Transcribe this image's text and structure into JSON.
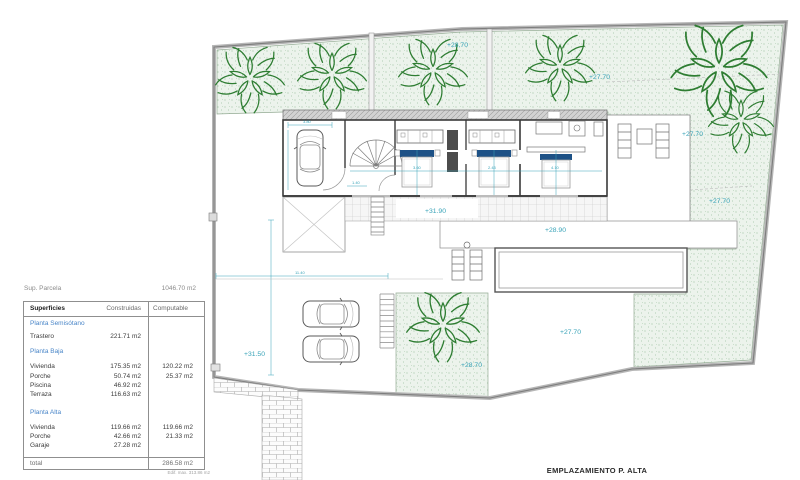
{
  "summary": {
    "label": "Sup. Parcela",
    "value": "1046.70 m2"
  },
  "table": {
    "col_name": "Superficies",
    "col_built": "Construidas",
    "col_comp": "Computable",
    "rows": [
      {
        "name": "Planta Semisótano",
        "section": true
      },
      {
        "name": "Trastero",
        "built": "221.71 m2",
        "comp": ""
      },
      {
        "name": "Planta Baja",
        "section": true
      },
      {
        "name": "Vivienda",
        "built": "175.35 m2",
        "comp": "120.22 m2"
      },
      {
        "name": "Porche",
        "built": "50.74 m2",
        "comp": "25.37 m2"
      },
      {
        "name": "Piscina",
        "built": "46.92 m2",
        "comp": ""
      },
      {
        "name": "Terraza",
        "built": "116.63 m2",
        "comp": ""
      },
      {
        "name": "Planta Alta",
        "section": true
      },
      {
        "name": "Vivienda",
        "built": "119.66 m2",
        "comp": "119.66 m2"
      },
      {
        "name": "Porche",
        "built": "42.66 m2",
        "comp": "21.33 m2"
      },
      {
        "name": "Garaje",
        "built": "27.28 m2",
        "comp": ""
      }
    ],
    "total_label": "total",
    "total_value": "286.58 m2",
    "footnote": "Edif. max. 313.86 m2"
  },
  "plan": {
    "title": "EMPLAZAMIENTO P. ALTA",
    "elevations": [
      {
        "text": "+28.70"
      },
      {
        "text": "+27.70"
      },
      {
        "text": "+27.70"
      },
      {
        "text": "+27.70"
      },
      {
        "text": "+31.90"
      },
      {
        "text": "+28.90"
      },
      {
        "text": "+27.70"
      },
      {
        "text": "+28.70"
      },
      {
        "text": "+31.50"
      }
    ],
    "dims": {
      "garage": "3.80",
      "room1": "3.60",
      "room2": "2.43",
      "room3": "4.10",
      "parking": "11.40",
      "hall": "1.40"
    },
    "colors": {
      "accent_cyan": "#38a3b8",
      "plant_green": "#2e7d32",
      "section_blue": "#4a86c8",
      "bed_navy": "#1d5186"
    }
  }
}
